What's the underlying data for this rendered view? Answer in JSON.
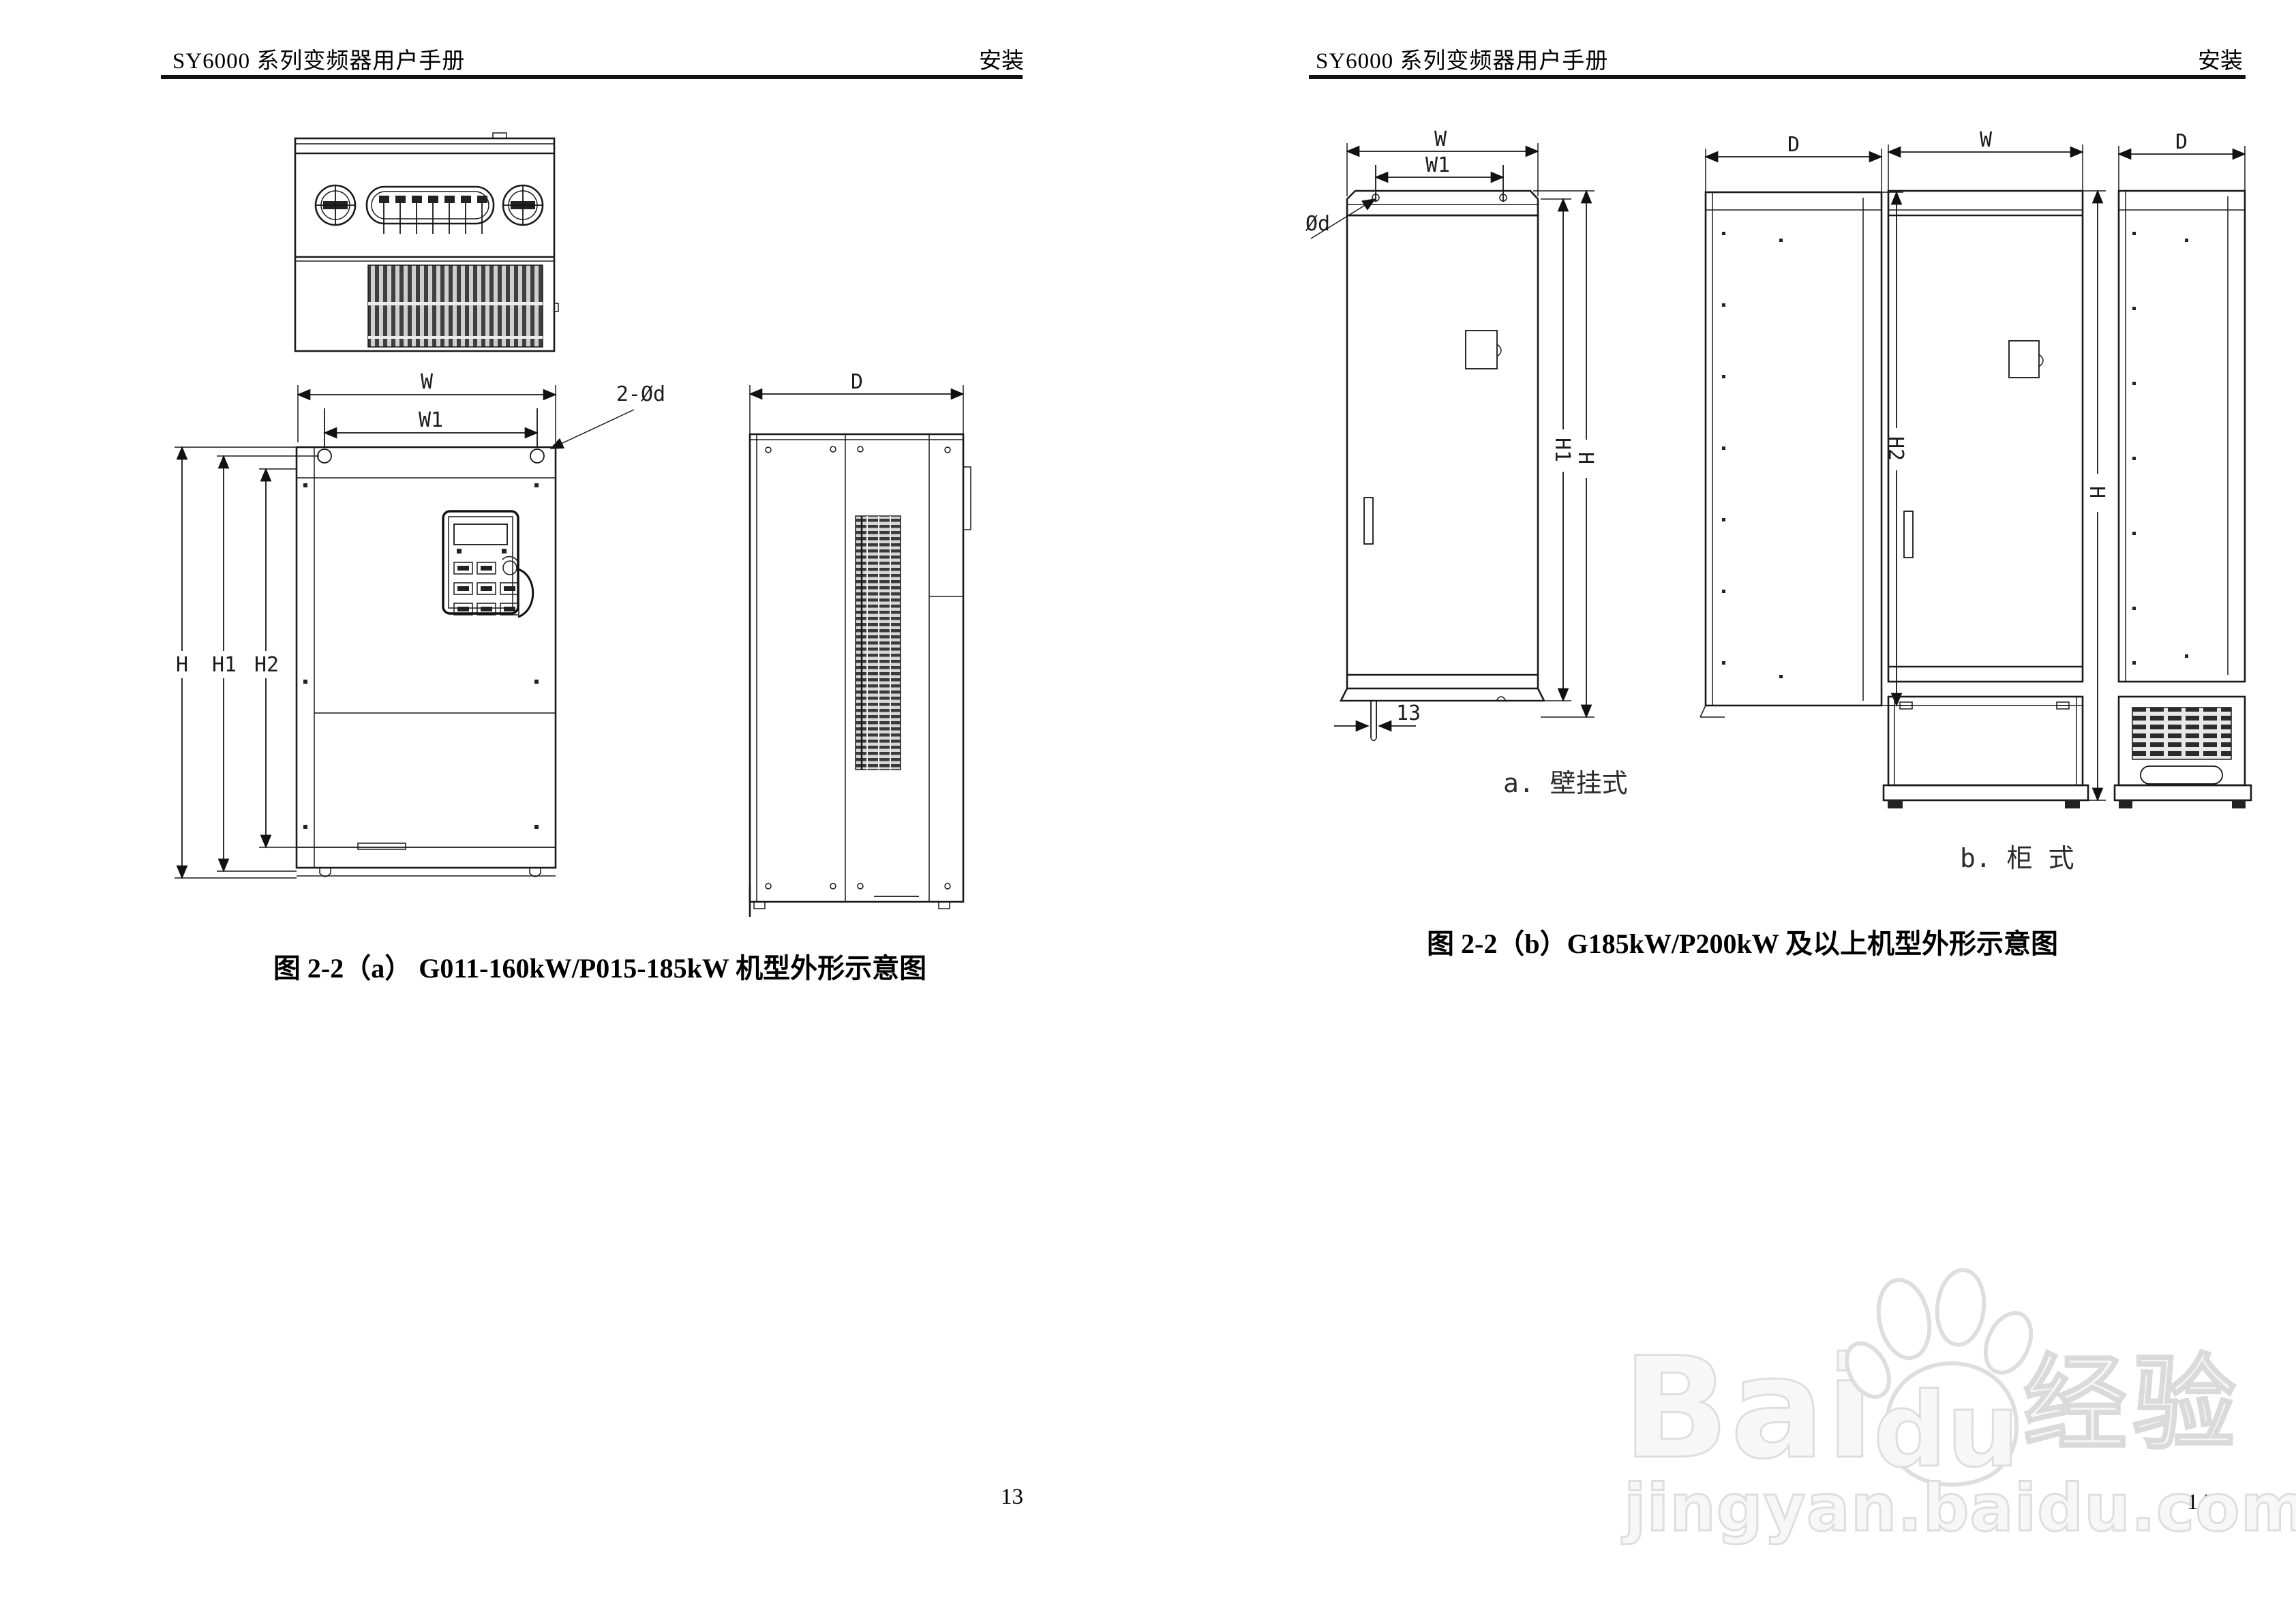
{
  "pages": {
    "left": {
      "header_title": "SY6000 系列变频器用户手册",
      "header_section": "安装",
      "caption": "图 2-2（a）  G011-160kW/P015-185kW 机型外形示意图",
      "page_number": "13"
    },
    "right": {
      "header_title": "SY6000 系列变频器用户手册",
      "header_section": "安装",
      "caption": "图 2-2（b）G185kW/P200kW 及以上机型外形示意图",
      "label_wall_mount": "a. 壁挂式",
      "label_cabinet": "b. 柜 式",
      "page_number": "14"
    }
  },
  "dim_labels": {
    "W": "W",
    "W1": "W1",
    "D": "D",
    "H": "H",
    "H1": "H1",
    "H2": "H2",
    "two_holes": "2-Ød",
    "hole": "Ød",
    "offset13": "13"
  },
  "watermark": {
    "word_bai": "Bai",
    "word_du": "du",
    "word_cn": "经验",
    "url": "jingyan.baidu.com",
    "color": "#dedede"
  },
  "drawing_colors": {
    "line": "#1a1a1a",
    "grille_fill": "#cfcfcf",
    "fin": "#3a3a3a"
  }
}
